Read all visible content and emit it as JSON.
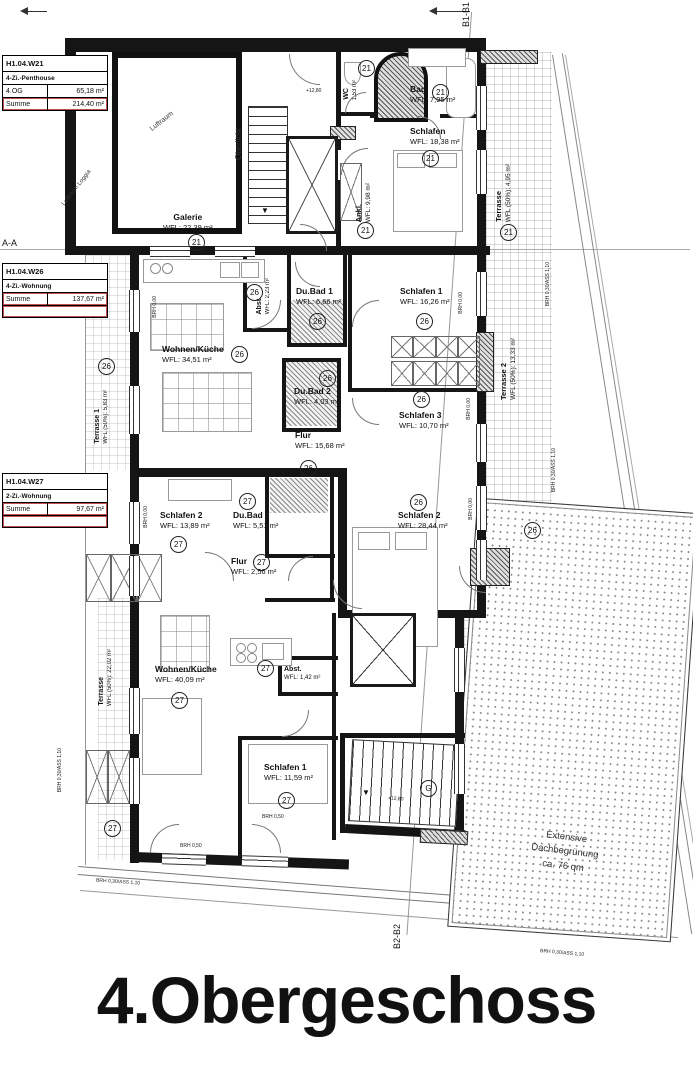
{
  "title": "4.Obergeschoss",
  "markers": {
    "aa": "A-A",
    "b1": "B1-B1",
    "b2": "B2-B2",
    "g": "G"
  },
  "units": {
    "penthouse": "21",
    "w26": "26",
    "w27": "27"
  },
  "info_boxes": [
    {
      "id": "H1.04.W21",
      "type": "4-Zi.-Penthouse",
      "rows": [
        {
          "label": "4.OG",
          "value": "65,18 m²"
        },
        {
          "label": "Summe",
          "value": "214,40 m²"
        }
      ]
    },
    {
      "id": "H1.04.W26",
      "type": "4-Zi.-Wohnung",
      "rows": [
        {
          "label": "Summe",
          "value": "137,67 m²"
        }
      ]
    },
    {
      "id": "H1.04.W27",
      "type": "2-Zi.-Wohnung",
      "rows": [
        {
          "label": "Summe",
          "value": "97,67 m²"
        }
      ]
    }
  ],
  "rooms": {
    "galerie": {
      "name": "Galerie",
      "area": "WFL: 22,39 m²"
    },
    "wc": {
      "name": "WC",
      "area": "1,53 m²"
    },
    "bad": {
      "name": "Bad",
      "area": "WFL: 7,95 m²"
    },
    "schlafen_ph": {
      "name": "Schlafen",
      "area": "WFL: 18,38 m²"
    },
    "ankl": {
      "name": "Ankl.",
      "area": "WFL: 9,98 m²"
    },
    "terrasse_ph": {
      "name": "Terrasse",
      "area": "WFL (50%): 4,95 m²"
    },
    "wohnen_w26": {
      "name": "Wohnen/Küche",
      "area": "WFL: 34,51 m²"
    },
    "abst_w26": {
      "name": "Abst.",
      "area": "WFL: 2,23 m²"
    },
    "dubad1_w26": {
      "name": "Du.Bad 1",
      "area": "WFL: 6,66 m²"
    },
    "schlafen1_w26": {
      "name": "Schlafen 1",
      "area": "WFL: 16,26 m²"
    },
    "terrasse2_w26": {
      "name": "Terrasse 2",
      "area": "WFL (50%): 13,33 m²"
    },
    "dubad2_w26": {
      "name": "Du.Bad 2",
      "area": "WFL: 4,03 m²"
    },
    "schlafen3_w26": {
      "name": "Schlafen 3",
      "area": "WFL: 10,70 m²"
    },
    "flur_w26": {
      "name": "Flur",
      "area": "WFL: 15,68 m²"
    },
    "terrasse1_w26": {
      "name": "Terrasse 1",
      "area": "WFL (50%): 5,83 m²"
    },
    "schlafen2_w26": {
      "name": "Schlafen 2",
      "area": "WFL: 28,44 m²"
    },
    "schlafen2_w27": {
      "name": "Schlafen 2",
      "area": "WFL: 13,89 m²"
    },
    "dubad_w27": {
      "name": "Du.Bad",
      "area": "WFL: 5,51 m²"
    },
    "flur_w27": {
      "name": "Flur",
      "area": "WFL: 2,56 m²"
    },
    "wohnen_w27": {
      "name": "Wohnen/Küche",
      "area": "WFL: 40,09 m²"
    },
    "abst_w27": {
      "name": "Abst.",
      "area": "WFL: 1,42 m²"
    },
    "schlafen1_w27": {
      "name": "Schlafen 1",
      "area": "WFL: 11,59 m²"
    }
  },
  "zones": {
    "luftraum": "Luftraum",
    "luftraum_loggia": "Luftraum Loggia",
    "oberlicht": "Oberlicht"
  },
  "roof_greening": {
    "line1": "Extensive",
    "line2": "Dachbegrünung",
    "line3": "ca. 76 qm"
  },
  "edge_labels": {
    "brh_ass": "BRH 0,30/ASS 1,10",
    "brh_000": "BRH 0,00",
    "brh_050": "BRH 0,50"
  },
  "levels": {
    "stair": "+12,80"
  }
}
